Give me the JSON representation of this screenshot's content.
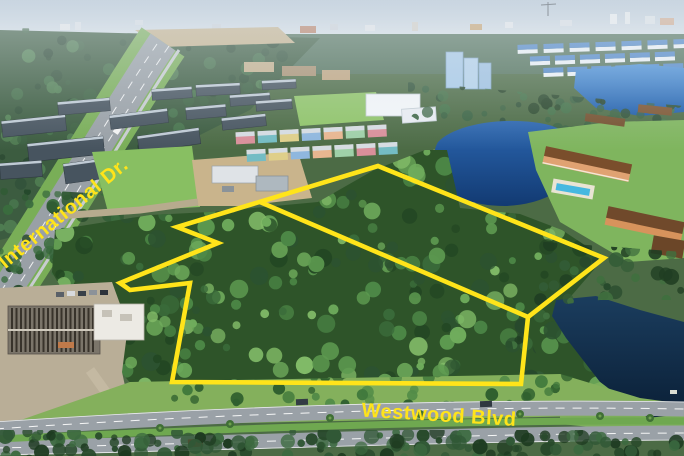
{
  "meta": {
    "description": "Aerial drone photograph of a wooded land parcel outlined in yellow, bordered by International Dr. and Westwood Blvd, with resorts, lakes and roads around it",
    "width_px": 684,
    "height_px": 456
  },
  "annotations": {
    "accent_color": "#ffe41a",
    "road_labels": [
      {
        "id": "international-dr",
        "text": "International Dr.",
        "x": 64,
        "y": 214,
        "rotation_deg": -39.5,
        "font_size": 20
      },
      {
        "id": "westwood-blvd",
        "text": "Westwood Blvd",
        "x": 439,
        "y": 416,
        "rotation_deg": 3.5,
        "font_size": 20
      }
    ],
    "parcel_outline": {
      "stroke_width": 4.6,
      "points": "378,166 604,258 528,317 521,384 172,382 190,283 130,290 120,283 218,243 177,227",
      "divider_points": "260,202 528,317"
    }
  },
  "scene": {
    "key_colors": {
      "sky": "#b3c3d3",
      "forest": "#3f6d3c",
      "pond_water": "#1c4a8c",
      "dark_lake": "#0e2a44",
      "road": "#9aa1a7",
      "grass": "#82b55c"
    }
  }
}
